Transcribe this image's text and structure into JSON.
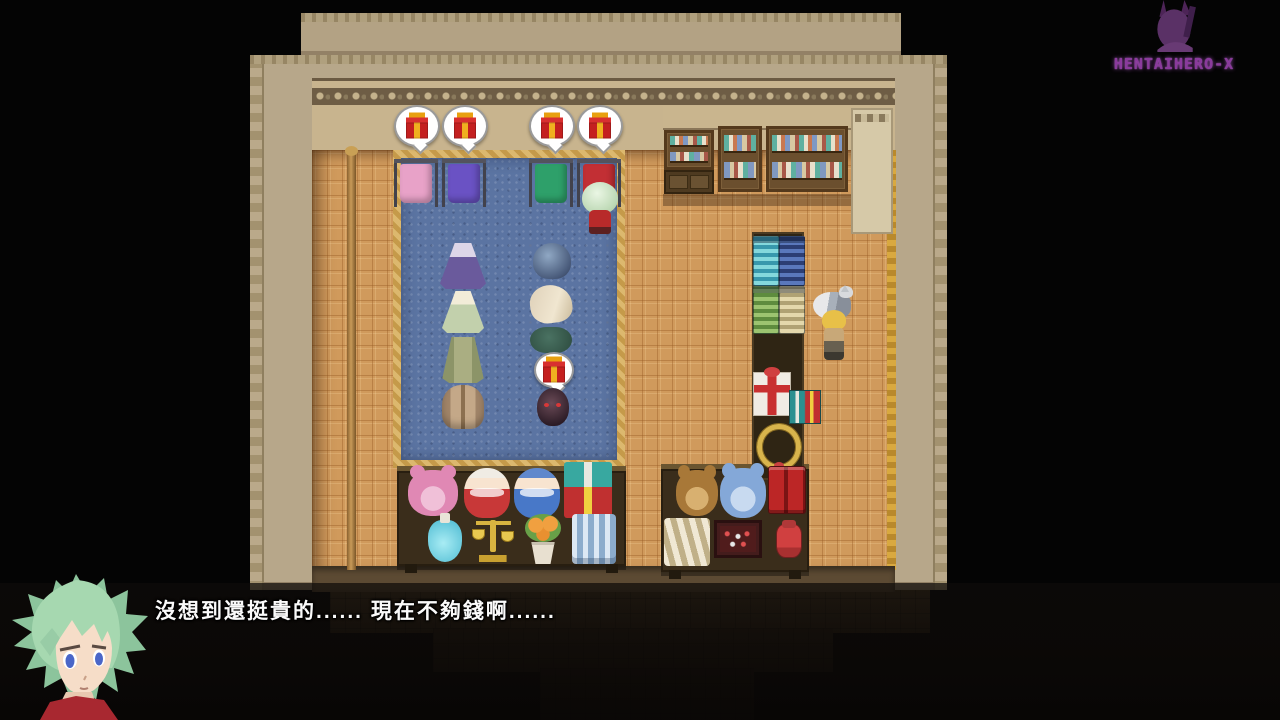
{
  "watermark": {
    "label": "HENTAIHERO-X",
    "color": "#8a3a9c",
    "figure_icon": "mascot-silhouette-icon"
  },
  "dialogue": {
    "text": "沒想到還挺貴的...... 現在不夠錢啊......",
    "speaker_portrait": "green-haired-hero"
  },
  "scene": {
    "description": "RPG Maker style gift and clothing shop interior, top-down view",
    "palette": {
      "background": "#040404",
      "floor": "#d09a5c",
      "carpet": "#5b74a2",
      "carpet_border": "#c99f4e",
      "wall": "#b7a78a",
      "roof": "#b3a284",
      "gift_red": "#c42020",
      "gift_ribbon_gold": "#f0b020",
      "accent_gold": "#d8b44c"
    },
    "sprites": [
      {
        "name": "table-left",
        "type": "table",
        "x": 397,
        "y": 466,
        "w": 229,
        "h": 100,
        "interactable": false
      },
      {
        "name": "table-right",
        "type": "table",
        "x": 661,
        "y": 464,
        "w": 148,
        "h": 108,
        "interactable": false
      },
      {
        "name": "shelf-top-band",
        "type": "shelf-band",
        "x": 663,
        "y": 106,
        "w": 208,
        "h": 24,
        "interactable": false
      },
      {
        "name": "shelf-unit-1",
        "type": "shelfunit",
        "x": 664,
        "y": 130,
        "w": 50,
        "h": 40,
        "interactable": true
      },
      {
        "name": "shelf-drawer-cabinet",
        "type": "cabinet",
        "x": 664,
        "y": 170,
        "w": 50,
        "h": 24,
        "interactable": true
      },
      {
        "name": "shelf-unit-2",
        "type": "shelfunit",
        "x": 718,
        "y": 126,
        "w": 44,
        "h": 66,
        "interactable": true
      },
      {
        "name": "shelf-unit-3",
        "type": "shelfunit",
        "x": 766,
        "y": 126,
        "w": 82,
        "h": 66,
        "interactable": true
      },
      {
        "name": "door-panel",
        "type": "door-panel",
        "x": 851,
        "y": 108,
        "w": 42,
        "h": 126,
        "interactable": false
      },
      {
        "name": "counter-strip",
        "type": "counter",
        "x": 752,
        "y": 232,
        "w": 52,
        "h": 248,
        "interactable": false
      },
      {
        "name": "fabric-bolt-cyan",
        "type": "bolt bolt-cyan",
        "x": 753,
        "y": 236,
        "w": 26,
        "h": 50,
        "interactable": true
      },
      {
        "name": "fabric-bolt-blue",
        "type": "bolt bolt-blue",
        "x": 779,
        "y": 236,
        "w": 26,
        "h": 50,
        "interactable": true
      },
      {
        "name": "fabric-bolt-green",
        "type": "bolt bolt-green",
        "x": 753,
        "y": 286,
        "w": 26,
        "h": 48,
        "interactable": true
      },
      {
        "name": "fabric-bolt-cream",
        "type": "bolt bolt-cream",
        "x": 779,
        "y": 286,
        "w": 26,
        "h": 48,
        "interactable": true
      },
      {
        "name": "gift-display-white",
        "type": "giftbox-white",
        "x": 753,
        "y": 372,
        "w": 38,
        "h": 44,
        "interactable": true
      },
      {
        "name": "gift-display-small",
        "type": "gifts-small",
        "x": 789,
        "y": 390,
        "w": 32,
        "h": 34,
        "interactable": true
      },
      {
        "name": "gold-ring-display",
        "type": "gold-ring",
        "x": 757,
        "y": 424,
        "w": 44,
        "h": 46,
        "interactable": true
      },
      {
        "name": "gift-bubble-1",
        "type": "bubble-gift",
        "x": 394,
        "y": 105,
        "w": 46,
        "h": 42,
        "interactable": true
      },
      {
        "name": "gift-bubble-2",
        "type": "bubble-gift",
        "x": 442,
        "y": 105,
        "w": 46,
        "h": 42,
        "interactable": true
      },
      {
        "name": "gift-bubble-3",
        "type": "bubble-gift",
        "x": 529,
        "y": 105,
        "w": 46,
        "h": 42,
        "interactable": true
      },
      {
        "name": "gift-bubble-4",
        "type": "bubble-gift",
        "x": 577,
        "y": 105,
        "w": 46,
        "h": 42,
        "interactable": true
      },
      {
        "name": "rack-shirt-pink",
        "type": "rack shirt-pink",
        "x": 394,
        "y": 161,
        "w": 44,
        "h": 46,
        "interactable": true
      },
      {
        "name": "rack-shirt-purple",
        "type": "rack shirt-purple",
        "x": 442,
        "y": 161,
        "w": 44,
        "h": 46,
        "interactable": true
      },
      {
        "name": "rack-shirt-green",
        "type": "rack shirt-green",
        "x": 529,
        "y": 161,
        "w": 44,
        "h": 46,
        "interactable": true
      },
      {
        "name": "rack-shirt-red",
        "type": "rack shirt-red",
        "x": 577,
        "y": 161,
        "w": 44,
        "h": 46,
        "interactable": true
      },
      {
        "name": "player-character",
        "type": "player",
        "x": 580,
        "y": 180,
        "w": 40,
        "h": 56,
        "interactable": true
      },
      {
        "name": "dress-purple",
        "type": "dress-purple",
        "x": 440,
        "y": 243,
        "w": 46,
        "h": 46,
        "interactable": true
      },
      {
        "name": "dress-white-green",
        "type": "dress-white",
        "x": 442,
        "y": 291,
        "w": 42,
        "h": 42,
        "interactable": true
      },
      {
        "name": "coat-green",
        "type": "coat-green",
        "x": 440,
        "y": 337,
        "w": 46,
        "h": 46,
        "interactable": true
      },
      {
        "name": "backpack-brown",
        "type": "pack-brown",
        "x": 442,
        "y": 385,
        "w": 42,
        "h": 44,
        "interactable": true
      },
      {
        "name": "helmet-blue",
        "type": "helmet-blue",
        "x": 533,
        "y": 243,
        "w": 38,
        "h": 36,
        "interactable": true
      },
      {
        "name": "hat-feathered",
        "type": "hat-feather",
        "x": 530,
        "y": 285,
        "w": 42,
        "h": 38,
        "interactable": true
      },
      {
        "name": "hat-green",
        "type": "hat-green",
        "x": 530,
        "y": 327,
        "w": 42,
        "h": 26,
        "interactable": true
      },
      {
        "name": "gift-bubble-small",
        "type": "bubble-gift",
        "x": 534,
        "y": 352,
        "w": 40,
        "h": 36,
        "interactable": true
      },
      {
        "name": "orb-dark",
        "type": "orb-dark",
        "x": 537,
        "y": 388,
        "w": 32,
        "h": 38,
        "interactable": true
      },
      {
        "name": "cat",
        "type": "cat",
        "x": 813,
        "y": 292,
        "w": 38,
        "h": 28,
        "interactable": true
      },
      {
        "name": "shopkeeper",
        "type": "keeper",
        "x": 818,
        "y": 310,
        "w": 32,
        "h": 54,
        "interactable": true
      },
      {
        "name": "teddy-bear-pink",
        "type": "bear bear-pink",
        "x": 408,
        "y": 470,
        "w": 50,
        "h": 46,
        "interactable": true
      },
      {
        "name": "doll-red",
        "type": "doll doll-red",
        "x": 464,
        "y": 468,
        "w": 46,
        "h": 50,
        "interactable": true
      },
      {
        "name": "doll-blue",
        "type": "doll doll-blue",
        "x": 514,
        "y": 468,
        "w": 46,
        "h": 50,
        "interactable": true
      },
      {
        "name": "gift-stack",
        "type": "giftstack",
        "x": 564,
        "y": 462,
        "w": 48,
        "h": 56,
        "interactable": true
      },
      {
        "name": "potion-blue",
        "type": "potion",
        "x": 428,
        "y": 520,
        "w": 34,
        "h": 42,
        "interactable": true
      },
      {
        "name": "gold-scales",
        "type": "scales",
        "x": 470,
        "y": 516,
        "w": 46,
        "h": 46,
        "interactable": true
      },
      {
        "name": "flower-pot",
        "type": "flowerpot",
        "x": 522,
        "y": 514,
        "w": 42,
        "h": 50,
        "interactable": true
      },
      {
        "name": "fabric-rolls-blue",
        "type": "rolls-blue",
        "x": 572,
        "y": 514,
        "w": 44,
        "h": 50,
        "interactable": true
      },
      {
        "name": "teddy-bear-brown",
        "type": "bear bear-brown",
        "x": 676,
        "y": 470,
        "w": 42,
        "h": 46,
        "interactable": true
      },
      {
        "name": "teddy-bear-blue",
        "type": "bear bear-blue",
        "x": 720,
        "y": 468,
        "w": 46,
        "h": 50,
        "interactable": true
      },
      {
        "name": "red-books",
        "type": "books-red",
        "x": 768,
        "y": 466,
        "w": 38,
        "h": 48,
        "interactable": true
      },
      {
        "name": "fabric-bundle-white",
        "type": "fabric-white",
        "x": 664,
        "y": 518,
        "w": 46,
        "h": 48,
        "interactable": true
      },
      {
        "name": "game-board",
        "type": "board-dark",
        "x": 714,
        "y": 520,
        "w": 48,
        "h": 38,
        "interactable": true
      },
      {
        "name": "jar-red",
        "type": "jar-red",
        "x": 776,
        "y": 524,
        "w": 26,
        "h": 34,
        "interactable": true
      }
    ]
  }
}
